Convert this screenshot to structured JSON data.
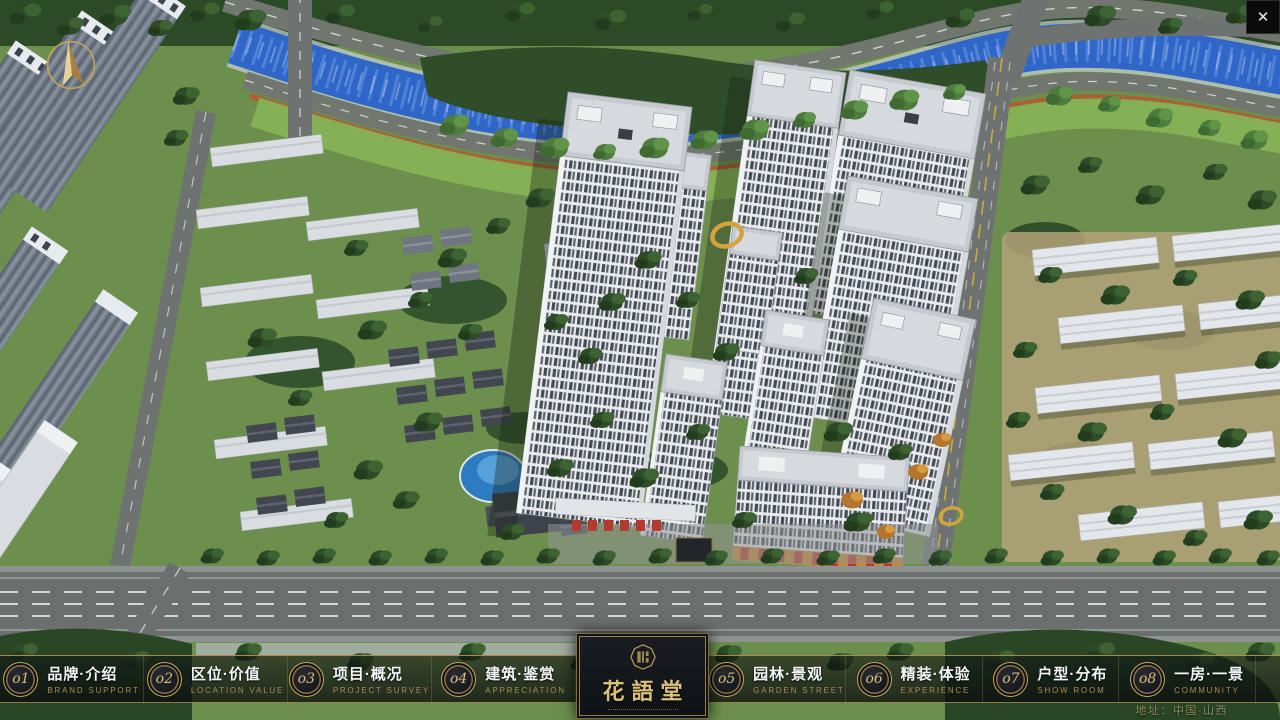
{
  "window": {
    "close_label": "✕"
  },
  "scene": {
    "kind": "aerial-masterplan-render",
    "colors": {
      "river": "#2f66c8",
      "lawn": "#86b556",
      "dark_trees": "#2c4926",
      "road": "#6e7271",
      "tower_facade": "#e8eaed",
      "tower_roof": "#c6cad0",
      "accent_gold": "#c9a961",
      "entrance_red": "#b5392c",
      "pool": "#2d7cc2"
    }
  },
  "navbar": {
    "items": [
      {
        "num": "o1",
        "title": "品牌·介绍",
        "subtitle": "BRAND SUPPORT"
      },
      {
        "num": "o2",
        "title": "区位·价值",
        "subtitle": "LOCATION VALUE"
      },
      {
        "num": "o3",
        "title": "项目·概况",
        "subtitle": "PROJECT SURVEY"
      },
      {
        "num": "o4",
        "title": "建筑·鉴赏",
        "subtitle": "APPRECIATION"
      },
      {
        "num": "o5",
        "title": "园林·景观",
        "subtitle": "GARDEN STREET"
      },
      {
        "num": "o6",
        "title": "精装·体验",
        "subtitle": "EXPERIENCE"
      },
      {
        "num": "o7",
        "title": "户型·分布",
        "subtitle": "SHOW ROOM"
      },
      {
        "num": "o8",
        "title": "一房·一景",
        "subtitle": "COMMUNITY"
      }
    ]
  },
  "logo": {
    "title": "花語堂"
  },
  "footer": {
    "address": "地址：中国·山西"
  }
}
